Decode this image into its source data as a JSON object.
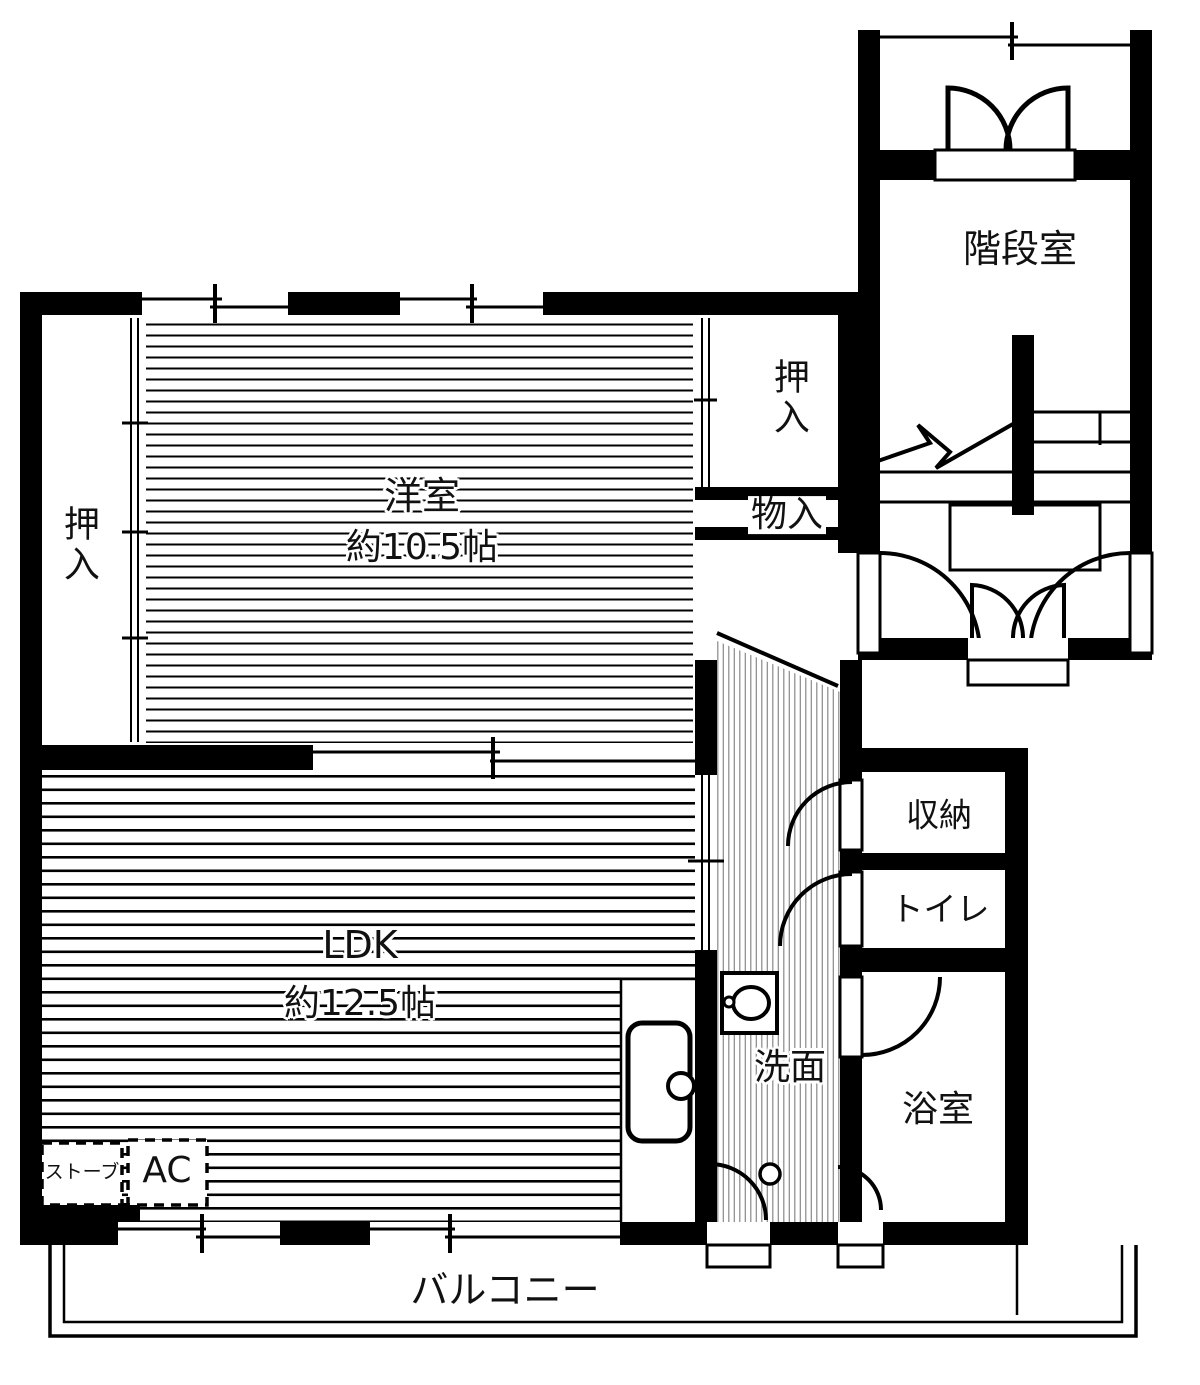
{
  "floorplan": {
    "rooms": {
      "stairwell": {
        "label": "階段室"
      },
      "closet_left": {
        "label": "押入"
      },
      "closet_right": {
        "label": "押入"
      },
      "storage_small": {
        "label": "物入"
      },
      "western_room": {
        "label": "洋室",
        "size": "約10.5帖"
      },
      "ldk": {
        "label": "LDK",
        "size": "約12.5帖"
      },
      "storage": {
        "label": "収納"
      },
      "toilet": {
        "label": "トイレ"
      },
      "washroom": {
        "label": "洗面"
      },
      "bathroom": {
        "label": "浴室"
      },
      "balcony": {
        "label": "バルコニー"
      }
    },
    "equipment": {
      "stove": "ストーブ",
      "ac": "AC"
    },
    "colors": {
      "wall": "#000000",
      "background": "#ffffff",
      "floor_line": "#000000",
      "hall_line": "#888888"
    }
  }
}
